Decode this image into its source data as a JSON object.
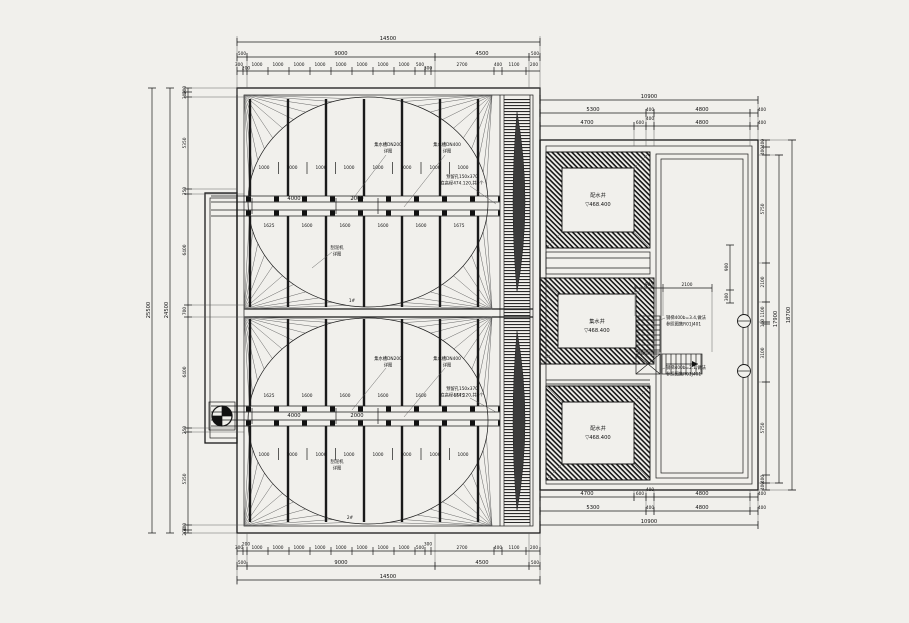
{
  "meta": {
    "background": "#f1f0ec",
    "ink": "#1a1a1a"
  },
  "dims": {
    "top": {
      "total": "14500",
      "row2": [
        "500",
        "9000",
        "4500",
        "500"
      ],
      "segs": [
        "300",
        "200",
        "1000",
        "1000",
        "1000",
        "1000",
        "1000",
        "1000",
        "1000",
        "1000",
        "500",
        "300",
        "2700",
        "400",
        "1100",
        "200"
      ]
    },
    "left": {
      "total_outer": "25500",
      "total_inner": "24500",
      "segs": [
        "200",
        "300",
        "5350",
        "250",
        "6400",
        "700",
        "6400",
        "250",
        "5350",
        "300",
        "200"
      ]
    },
    "right": {
      "total": "10900",
      "rowA": [
        "5300",
        "400",
        "4800",
        "400"
      ],
      "rowB": [
        "4700",
        "600",
        "400",
        "4800",
        "400"
      ]
    },
    "right_side": {
      "total_inner": "17900",
      "total_outer": "18700",
      "segs": [
        "400",
        "400",
        "5750",
        "2100",
        "1100",
        "100",
        "3100",
        "5750",
        "400",
        "400"
      ]
    },
    "stair": {
      "h": [
        "900",
        "2100"
      ],
      "v": [
        "900",
        "300"
      ]
    },
    "tank": {
      "thousands": [
        "1000",
        "1000",
        "1000",
        "1000",
        "1000",
        "1000",
        "1000",
        "1000"
      ],
      "walkway": [
        "4000",
        "2000"
      ],
      "cells": [
        "1625",
        "1600",
        "1600",
        "1600",
        "1600",
        "1675"
      ]
    }
  },
  "annotations": {
    "dn200": [
      "集水槽DN200",
      "详图"
    ],
    "dn400": [
      "集水槽DN400",
      "详图"
    ],
    "hole": [
      "预留孔150x370",
      "底高程474.120,共6个"
    ],
    "scraper": [
      "刮泥机",
      "详图"
    ],
    "tag1": "1#",
    "tag2": "2#",
    "note1": [
      "钢梯400b=3.4,做法",
      "参照图集R01J401"
    ],
    "note2": [
      "钢梯400b=2.1,做法",
      "参照图集R01J401"
    ]
  },
  "chambers": {
    "top": {
      "name": "配水井",
      "level": "▽468.400"
    },
    "mid": {
      "name": "集水井",
      "level": "▽468.400"
    },
    "bottom": {
      "name": "配水井",
      "level": "▽468.400"
    }
  }
}
